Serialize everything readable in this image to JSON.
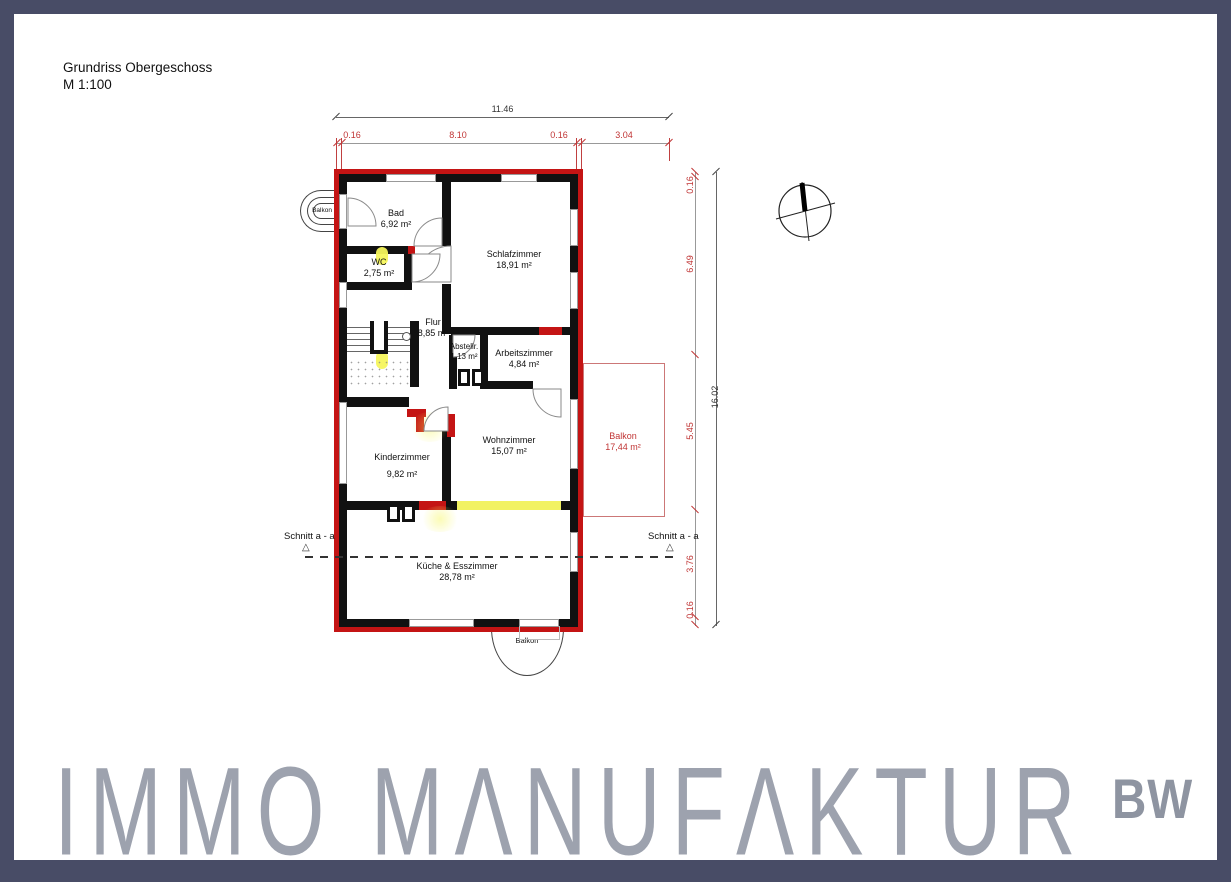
{
  "page": {
    "title": "Grundriss Obergeschoss",
    "scale": "M 1:100"
  },
  "plan": {
    "rooms": [
      {
        "name": "Bad",
        "area": "6,92 m²"
      },
      {
        "name": "WC",
        "area": "2,75 m²"
      },
      {
        "name": "Schlafzimmer",
        "area": "18,91 m²"
      },
      {
        "name": "Flur",
        "area": "8,85 m²"
      },
      {
        "name": "Abstellr.",
        "area": "1,13 m²"
      },
      {
        "name": "Arbeitszimmer",
        "area": "4,84 m²"
      },
      {
        "name": "Kinderzimmer",
        "area": "9,82 m²"
      },
      {
        "name": "Wohnzimmer",
        "area": "15,07 m²"
      },
      {
        "name": "Küche & Esszimmer",
        "area": "28,78 m²"
      },
      {
        "name": "Balkon",
        "area": "17,44 m²"
      }
    ],
    "balconies": {
      "top_left": "Balkon",
      "bottom": "Balkon"
    },
    "section": {
      "left": "Schnitt a - a",
      "right": "Schnitt a - a"
    },
    "dims": {
      "top_total": "11.46",
      "top_chain": [
        "0.16",
        "8.10",
        "0.16",
        "3.04"
      ],
      "right_total": "16.02",
      "right_chain": [
        "0.16",
        "6.49",
        "5.45",
        "3.76",
        "0.16"
      ]
    },
    "colors": {
      "exterior_wall_red": "#c41414",
      "interior_wall_black": "#111111",
      "dimension_red": "#c03535",
      "highlight_yellow": "#f2f263",
      "balcony_outline_red": "#cc7777",
      "frame_navy": "#484c66"
    }
  },
  "watermark": {
    "brand": "IMMO MΛNUFΛKTUR",
    "suffix": "BW",
    "color": "#9da2ae"
  }
}
